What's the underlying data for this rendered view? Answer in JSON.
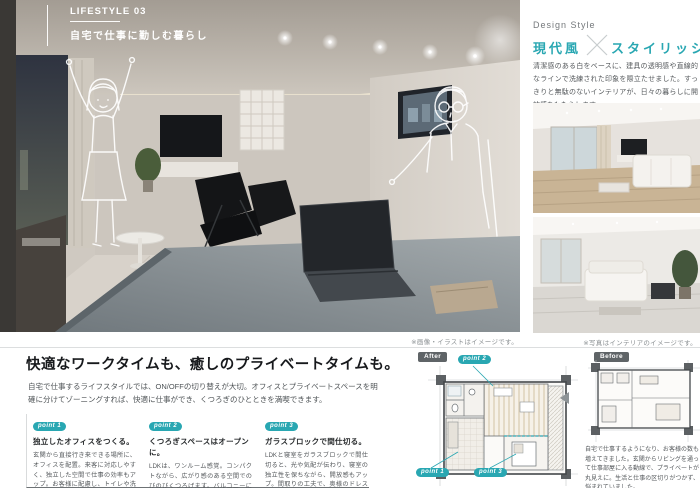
{
  "page": {
    "lifestyle_label": "LIFESTYLE 03",
    "lifestyle_title": "自宅で仕事に勤しむ暮らし",
    "photo_caption": "※画像・イラストはイメージです。"
  },
  "design_style": {
    "label": "Design Style",
    "style_left": "現代風",
    "style_right": "スタイリッシュ",
    "description": "清潔感のある白をベースに、建具の透明感や直線的なラインで洗練された印象を際立たせました。すっきりと無駄のないインテリアが、日々の暮らしに開放感をもたらします。",
    "photo_caption": "※写真はインテリアのイメージです。"
  },
  "feature": {
    "heading": "快適なワークタイムも、癒しのプライベートタイムも。",
    "lead": "自宅で仕事するライフスタイルでは、ON/OFFの切り替えが大切。オフィスとプライベートスペースを明確に分けてゾーニングすれば、快適に仕事ができ、くつろぎのひとときを満喫できます。",
    "points": [
      {
        "badge": "point 1",
        "title": "独立したオフィスをつくる。",
        "body": "玄関から直接行き来できる場所に、オフィスを配置。来客に対応しやすく、独立した空間で仕事の効率もアップ。お客様に配慮し、トイレや洗面をすぐ側に設けました。"
      },
      {
        "badge": "point 2",
        "title": "くつろぎスペースはオープンに。",
        "body": "LDKは、ワンルーム感覚。コンパクトながら、広がり感のある空間でのびのびくつろげます。バルコニーに面したソファに座れば、食後のだんらんもゆったりと。"
      },
      {
        "badge": "point 3",
        "title": "ガラスブロックで間仕切る。",
        "body": "LDKと寝室をガラスブロックで間仕切ると、光や気配が伝わり、寝室の独立性を保ちながら、開放感もアップ。間取りの工夫で、奥様のドレスコーナーもつくりました。"
      }
    ]
  },
  "plans": {
    "after_label": "After",
    "before_label": "Before",
    "after_points": [
      "point 2",
      "point 1",
      "point 3"
    ],
    "before_description": "自宅で仕事するようになり、お客様の数も増えてきました。玄関からリビングを通って仕事部屋に入る動線で、プライベートが丸見えに。生活と仕事の区切りがつかず、悩まれていました。"
  },
  "colors": {
    "accent": "#29a7b2",
    "badge_dark": "#5f6467"
  }
}
